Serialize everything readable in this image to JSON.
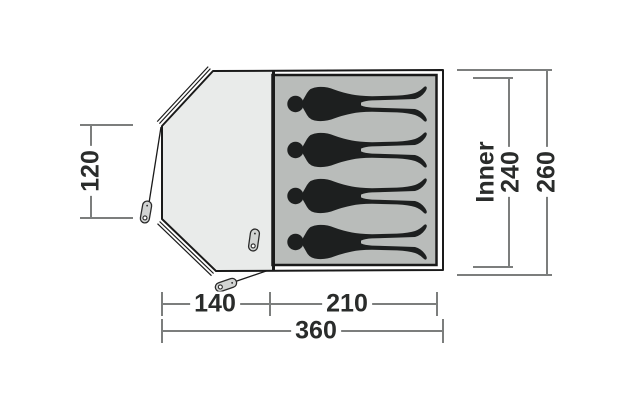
{
  "diagram": {
    "title": "tent-floorplan-top-view",
    "occupant_count": 4,
    "areas": {
      "porch": "vestibule area (light grey, left)",
      "inner": "inner sleeping cabin (grey, right) with 4 sleeper silhouettes"
    },
    "dimensions": {
      "porch_side_height": "120",
      "inner_word": "Inner",
      "inner_depth": "240",
      "total_depth": "260",
      "porch_width": "140",
      "inner_width": "210",
      "total_width": "360"
    },
    "colors": {
      "outline": "#1a1a1a",
      "porch_fill": "#e9ebea",
      "inner_fill": "#b9bcba",
      "silhouette": "#1d1f1f",
      "dimension_line": "#7c7e7d",
      "dimension_text": "#2a2c2b",
      "peg_fill": "#d2d4d3",
      "background": "#ffffff"
    }
  }
}
